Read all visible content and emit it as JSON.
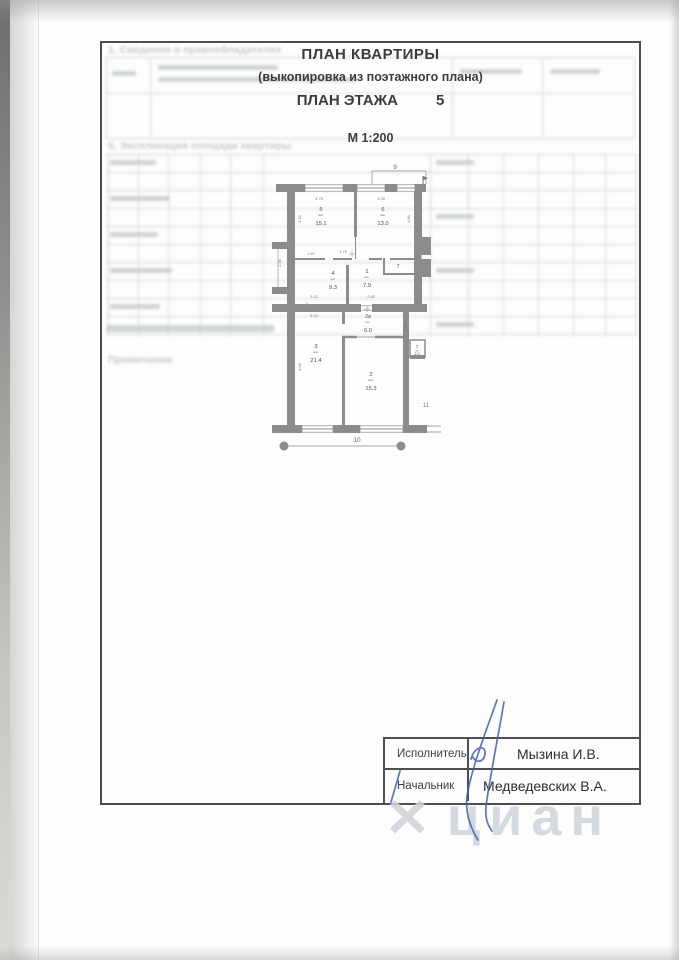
{
  "page": {
    "title": "ПЛАН КВАРТИРЫ",
    "subtitle": "(выкопировка  из поэтажного плана)",
    "floor_label": "ПЛАН ЭТАЖА",
    "floor_number": "5",
    "scale": "М 1:200"
  },
  "plan": {
    "axis": {
      "top": "9",
      "bottom": "10",
      "right": "11"
    },
    "rooms": [
      {
        "num": "5",
        "type": "жил.",
        "area": "15.1"
      },
      {
        "num": "6",
        "type": "жил.",
        "area": "13.0"
      },
      {
        "num": "4",
        "type": "кух.",
        "area": "9.3"
      },
      {
        "num": "1",
        "type": "кор.",
        "area": "7.9"
      },
      {
        "num": "7",
        "type": "",
        "area": ""
      },
      {
        "num": "2а",
        "type": "кор.",
        "area": "6.0"
      },
      {
        "num": "3",
        "type": "жил.",
        "area": "21.4"
      },
      {
        "num": "2",
        "type": "жил.",
        "area": "15.3"
      },
      {
        "num": "7",
        "type": "с/у",
        "area": "2.9"
      }
    ],
    "dims": {
      "t1": "4.75",
      "t2": "3.38",
      "m1": "1.87",
      "m2": "1.75",
      "b1": "3.12",
      "b2": "2.80",
      "b3": "3.12",
      "s1": "3.20",
      "s2": "3.85",
      "s3": "2.38",
      "s4": "0.90",
      "s5": "6.08"
    }
  },
  "signature_table": {
    "rows": [
      {
        "role": "Исполнитель",
        "name": "Мызина И.В."
      },
      {
        "role": "Начальник",
        "name": "Медведевских В.А."
      }
    ]
  },
  "watermark": {
    "mark": "✕",
    "text": "циан"
  },
  "ghost": {
    "heading_top": "1. Сведения о правообладателях",
    "heading_mid": "5. Экспликация площади квартиры",
    "note": "Примечание"
  },
  "colors": {
    "wall_gray": "#8c8c8c",
    "frame_ink": "#4d4d4d",
    "signature_blue": "#3e61b0",
    "watermark_gray": "#ccd3d9",
    "ghost_green": "#7f938a"
  }
}
